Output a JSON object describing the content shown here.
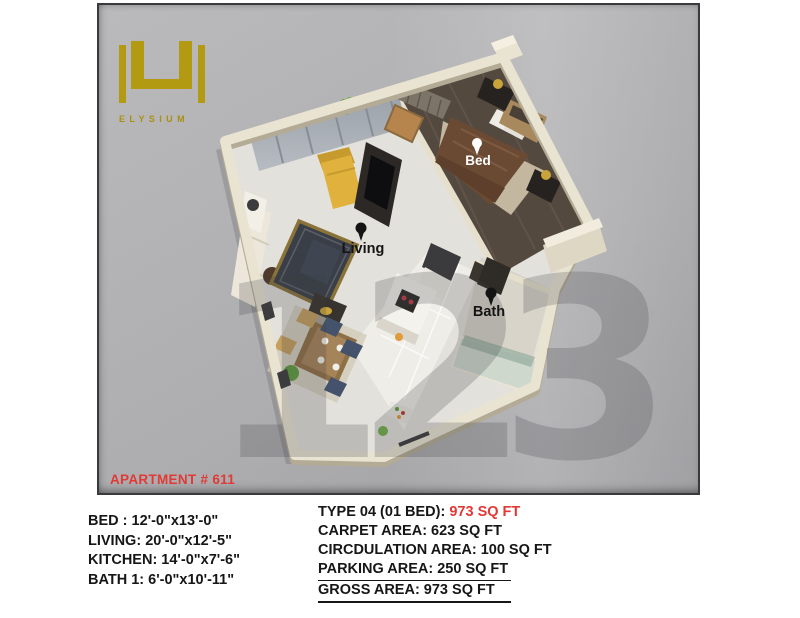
{
  "colors": {
    "brand_gold": "#b29a12",
    "accent_red": "#e03936",
    "photo_bg_gray": "#b0b0b2",
    "wall_cream": "#e9e3d2",
    "wood_floor_brown": "#54493e"
  },
  "logo": {
    "brand": "ELYSIUM"
  },
  "photo": {
    "apartment_label": "APARTMENT # 611",
    "watermark": "123",
    "rooms": {
      "bed": "Bed",
      "living": "Living",
      "bath": "Bath"
    }
  },
  "specs": {
    "left": [
      "BED : 12'-0\"x13'-0\"",
      "LIVING: 20'-0\"x12'-5\"",
      "KITCHEN: 14'-0\"x7'-6\"",
      "BATH 1: 6'-0\"x10'-11\""
    ],
    "right": {
      "type_label": "TYPE 04 (01 BED): ",
      "type_value": "973 SQ FT",
      "carpet": "CARPET AREA: 623 SQ FT",
      "circulation": "CIRCDULATION AREA: 100 SQ FT",
      "parking": "PARKING AREA: 250 SQ FT",
      "gross": "GROSS AREA: 973 SQ FT"
    }
  }
}
